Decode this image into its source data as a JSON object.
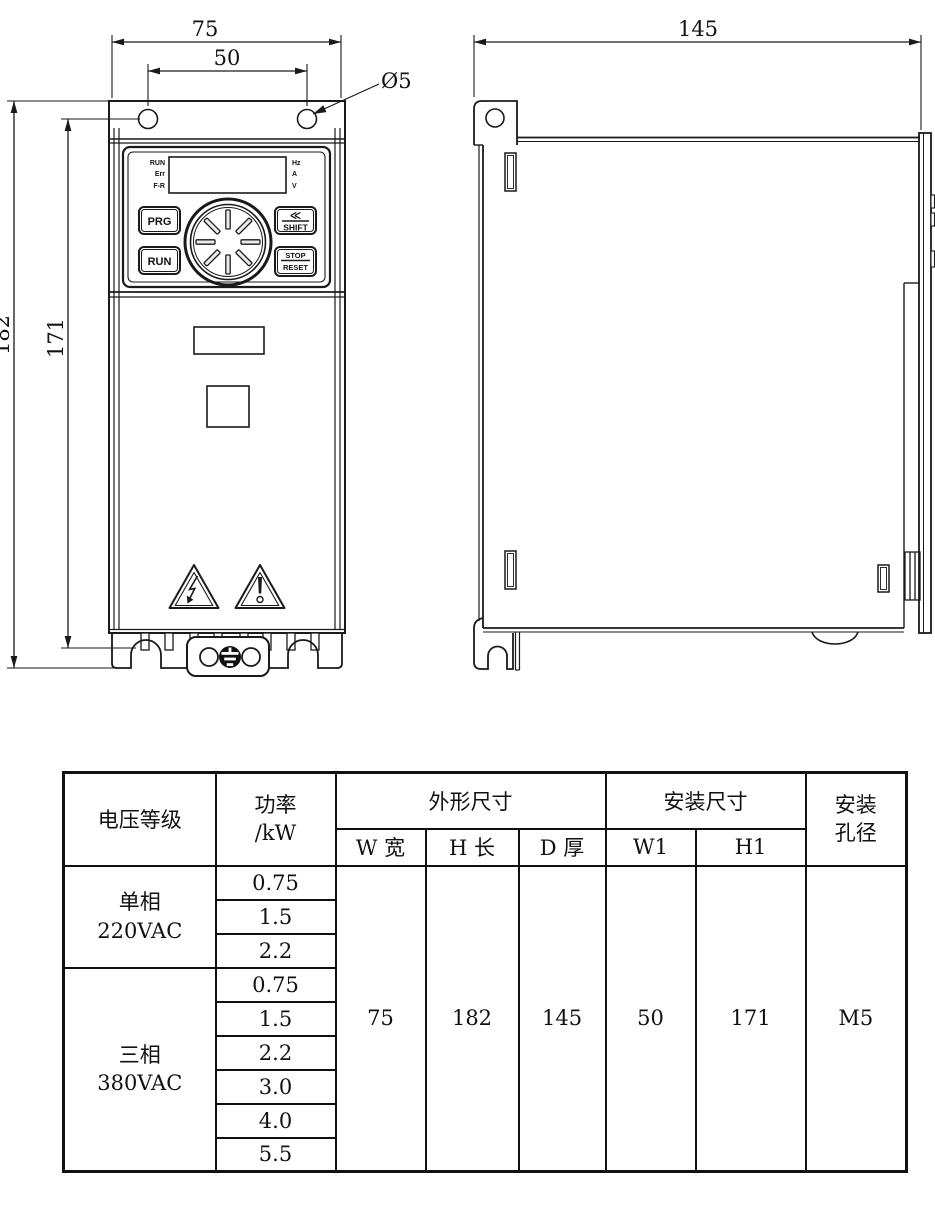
{
  "drawing": {
    "front_view": {
      "dims": {
        "width": "75",
        "hole_spacing": "50",
        "hole_diameter": "Ø5",
        "height": "182",
        "mount_height": "171"
      },
      "keypad": {
        "indicators": [
          "RUN",
          "Err",
          "F-R"
        ],
        "units": [
          "Hz",
          "A",
          "V"
        ],
        "prg": "PRG",
        "run": "RUN",
        "shift_chevron": "≪",
        "shift": "SHIFT",
        "stop": "STOP",
        "reset": "RESET"
      }
    },
    "side_view": {
      "dims": {
        "depth": "145"
      }
    }
  },
  "table": {
    "header": {
      "voltage": "电压等级",
      "power_line1": "功率",
      "power_line2": "/kW",
      "outline_group": "外形尺寸",
      "mount_group": "安装尺寸",
      "hole_line1": "安装",
      "hole_line2": "孔径",
      "sub": [
        "W 宽",
        "H 长",
        "D 厚",
        "W1",
        "H1"
      ]
    },
    "groups": [
      {
        "label_line1": "单相",
        "label_line2": "220VAC",
        "powers": [
          "0.75",
          "1.5",
          "2.2"
        ]
      },
      {
        "label_line1": "三相",
        "label_line2": "380VAC",
        "powers": [
          "0.75",
          "1.5",
          "2.2",
          "3.0",
          "4.0",
          "5.5"
        ]
      }
    ],
    "values": {
      "w": "75",
      "h": "182",
      "d": "145",
      "w1": "50",
      "h1": "171",
      "hole": "M5"
    }
  }
}
